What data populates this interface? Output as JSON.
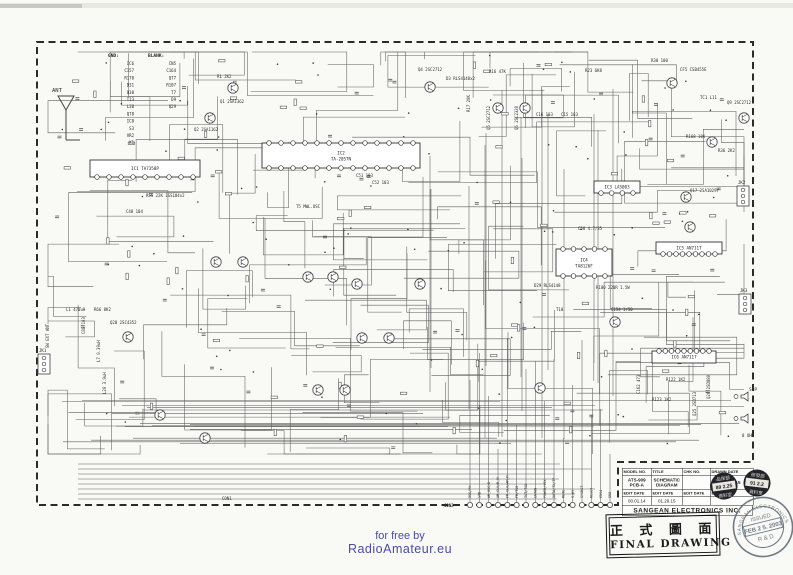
{
  "footer": {
    "line1": "for free by",
    "line2": "RadioAmateur.eu",
    "color": "#4b4ba6"
  },
  "title_block": {
    "headers": [
      "MODEL NO.",
      "TITLE",
      "CHK NO.",
      "DRAWN DATE"
    ],
    "values": [
      "ATS-909 PCB-A",
      "SCHEMATIC DIAGRAM",
      "",
      "99.12.15"
    ],
    "edit_headers": [
      "EDIT DATE",
      "EDIT DATE",
      "EDIT DATE",
      "EDIT DATE"
    ],
    "edit_values": [
      "00.01.14",
      "01.29.15",
      "",
      ""
    ],
    "company": "SANGEAN ELECTRONICS INC."
  },
  "final_drawing": {
    "chinese": "正 式 圖 面",
    "english": "FINAL DRAWING"
  },
  "round_stamp": {
    "ring": "SANGEAN ELECTRONICS",
    "line1": "ISSUED",
    "line2": "FEB 2 5. 2003",
    "line3": "R & D",
    "color": "#5a6672"
  },
  "date_stamps": [
    {
      "top": "品保部",
      "date": "89 2.25",
      "bottom": "資料室"
    },
    {
      "top": "研發部",
      "date": "91 2.2",
      "bottom": "資料室"
    }
  ],
  "schematic": {
    "gnd_title": "GND:",
    "gnd_list": [
      "IC6",
      "C157",
      "R170",
      "D31",
      "Q38",
      "T13",
      "L30",
      "Q78",
      "IC8",
      "S3",
      "VR2",
      "K1"
    ],
    "blank_title": "BLANK:",
    "blank_list": [
      "CN5",
      "C164",
      "Q77",
      "R107",
      "T7",
      "D9",
      "Q29"
    ],
    "ics": [
      {
        "ref": "IC1",
        "part": "TA7358P",
        "x": 90,
        "y": 160,
        "w": 110,
        "h": 17,
        "pins": 9,
        "side": "bottom"
      },
      {
        "ref": "IC2",
        "part": "TA-2057N",
        "x": 262,
        "y": 143,
        "w": 158,
        "h": 25,
        "pins": 13,
        "side": "both"
      },
      {
        "ref": "IC3",
        "part": "LA5003",
        "x": 594,
        "y": 181,
        "w": 46,
        "h": 12,
        "pins": 4,
        "side": "bottom"
      },
      {
        "ref": "IC4",
        "part": "TA8126F",
        "x": 556,
        "y": 249,
        "w": 56,
        "h": 27,
        "pins": 5,
        "side": "both"
      },
      {
        "ref": "IC5",
        "part": "AN7117",
        "x": 656,
        "y": 242,
        "w": 66,
        "h": 12,
        "pins": 9,
        "side": "bottom"
      },
      {
        "ref": "IC6",
        "part": "AN7117",
        "x": 652,
        "y": 351,
        "w": 64,
        "h": 12,
        "pins": 9,
        "side": "top"
      }
    ],
    "transistors": [
      [
        233,
        88
      ],
      [
        210,
        118
      ],
      [
        430,
        87
      ],
      [
        498,
        108
      ],
      [
        525,
        108
      ],
      [
        672,
        83
      ],
      [
        712,
        142
      ],
      [
        744,
        118
      ],
      [
        686,
        197
      ],
      [
        690,
        227
      ],
      [
        128,
        337
      ],
      [
        308,
        277
      ],
      [
        333,
        277
      ],
      [
        357,
        284
      ],
      [
        420,
        284
      ],
      [
        362,
        338
      ],
      [
        389,
        338
      ],
      [
        216,
        262
      ],
      [
        243,
        262
      ],
      [
        540,
        388
      ],
      [
        615,
        322
      ],
      [
        318,
        390
      ],
      [
        345,
        390
      ],
      [
        160,
        415
      ],
      [
        205,
        438
      ]
    ],
    "labels": [
      {
        "t": "ANT",
        "x": 52,
        "y": 92,
        "s": 5.5
      },
      {
        "t": "R1 2K2",
        "x": 217,
        "y": 78
      },
      {
        "t": "Q1 2SA1362",
        "x": 220,
        "y": 103
      },
      {
        "t": "Q2 2SA1162",
        "x": 194,
        "y": 131
      },
      {
        "t": "Q4 2SC2712",
        "x": 418,
        "y": 71
      },
      {
        "t": "D3 RLS4148x2",
        "x": 446,
        "y": 80
      },
      {
        "t": "R16 47K",
        "x": 489,
        "y": 73
      },
      {
        "t": "R17 20K",
        "x": 470,
        "y": 112,
        "v": true
      },
      {
        "t": "Q5 2SC2712",
        "x": 490,
        "y": 130,
        "v": true
      },
      {
        "t": "Q6 2SC2320",
        "x": 518,
        "y": 130,
        "v": true
      },
      {
        "t": "C16 103",
        "x": 536,
        "y": 116
      },
      {
        "t": "C15 103",
        "x": 561,
        "y": 116
      },
      {
        "t": "R23 6K8",
        "x": 585,
        "y": 72
      },
      {
        "t": "CF5 CSB455E",
        "x": 680,
        "y": 71
      },
      {
        "t": "TC1 L11",
        "x": 700,
        "y": 99
      },
      {
        "t": "Q9 2SC2712",
        "x": 727,
        "y": 104
      },
      {
        "t": "R168 10K",
        "x": 686,
        "y": 138
      },
      {
        "t": "R36 2K2",
        "x": 718,
        "y": 152
      },
      {
        "t": "R30 100",
        "x": 651,
        "y": 62
      },
      {
        "t": "R55 22K 1SS184x2",
        "x": 146,
        "y": 197
      },
      {
        "t": "C48 104",
        "x": 126,
        "y": 213
      },
      {
        "t": "T5 MWL.OSC",
        "x": 296,
        "y": 208
      },
      {
        "t": "C51 103",
        "x": 356,
        "y": 177
      },
      {
        "t": "C52 103",
        "x": 372,
        "y": 184
      },
      {
        "t": "Q17 2SA1029Y",
        "x": 690,
        "y": 192
      },
      {
        "t": "C58 4.7/35",
        "x": 578,
        "y": 230
      },
      {
        "t": "D29 RLS4148",
        "x": 534,
        "y": 287
      },
      {
        "t": "T10",
        "x": 556,
        "y": 311
      },
      {
        "t": "R100 220R 1.5W",
        "x": 596,
        "y": 289
      },
      {
        "t": "C154 1/50",
        "x": 611,
        "y": 311
      },
      {
        "t": "L1 470uH",
        "x": 66,
        "y": 311
      },
      {
        "t": "R66 8K2",
        "x": 94,
        "y": 311
      },
      {
        "t": "C88 103",
        "x": 85,
        "y": 334,
        "v": true
      },
      {
        "t": "Q20 2SC4352",
        "x": 110,
        "y": 324
      },
      {
        "t": "L7 0.39uH",
        "x": 100,
        "y": 362,
        "v": true
      },
      {
        "t": "L20 3.9uH",
        "x": 106,
        "y": 394,
        "v": true
      },
      {
        "t": "SW EXT ANT",
        "x": 49,
        "y": 348,
        "v": true
      },
      {
        "t": "R122 1K2",
        "x": 666,
        "y": 381
      },
      {
        "t": "C162 473",
        "x": 640,
        "y": 394,
        "v": true
      },
      {
        "t": "R123 1K2",
        "x": 652,
        "y": 401
      },
      {
        "t": "Q26 2SD880",
        "x": 710,
        "y": 399,
        "v": true
      },
      {
        "t": "Q25 2SD713",
        "x": 696,
        "y": 416,
        "v": true
      },
      {
        "t": "S.P",
        "x": 749,
        "y": 391,
        "s": 4.5
      },
      {
        "t": "8 OHM",
        "x": 742,
        "y": 437
      },
      {
        "t": "CON1",
        "x": 222,
        "y": 500
      }
    ],
    "jacks": [
      {
        "label": "JK1",
        "x": 38,
        "y": 354
      },
      {
        "label": "JK2",
        "x": 737,
        "y": 186
      },
      {
        "label": "JK3",
        "x": 739,
        "y": 294
      }
    ],
    "speakers": [
      [
        741,
        395
      ],
      [
        741,
        417
      ]
    ],
    "con2": {
      "label": "CON2",
      "pins": [
        "OSC/PH",
        "STB",
        "AM_OSC/D",
        "AM_CLK/R_M",
        "FM_CLK/AM_M",
        "FM/TSD",
        "TST/TSD",
        "ENTON",
        "POWER/VOX",
        "DATA/TX/TP",
        "MUTE",
        "9.6V",
        "SYSRST",
        "RESET",
        "EDS4",
        "GND"
      ]
    }
  }
}
